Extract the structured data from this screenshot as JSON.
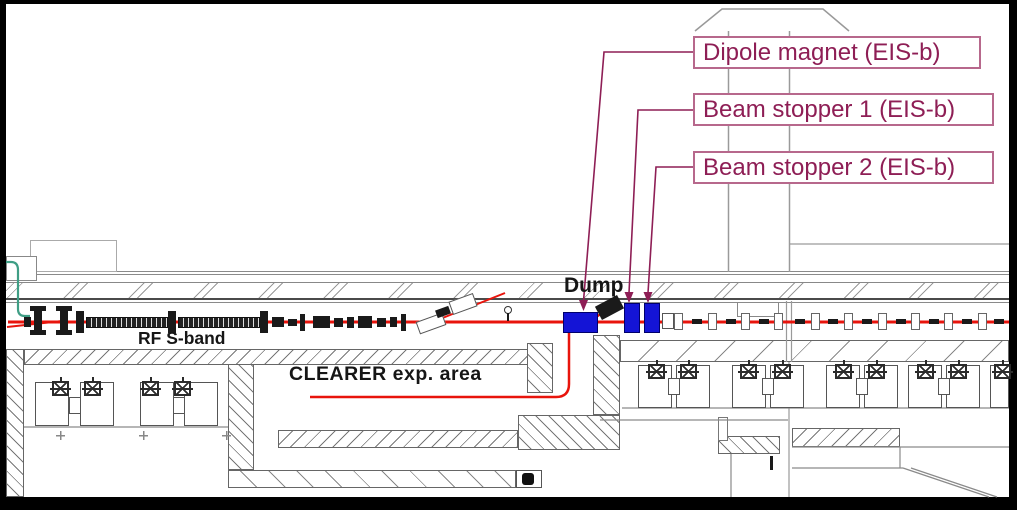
{
  "drawing": {
    "type": "accelerator-beamline-floor-plan",
    "callouts": [
      {
        "label": "Dipole magnet (EIS-b)",
        "target": "dipole-magnet"
      },
      {
        "label": "Beam stopper 1 (EIS-b)",
        "target": "beam-stopper-1"
      },
      {
        "label": "Beam stopper 2 (EIS-b)",
        "target": "beam-stopper-2"
      }
    ],
    "inline_labels": {
      "dump": "Dump",
      "rf_band": "RF S-band",
      "experimental_area": "CLEARER exp. area"
    },
    "components": [
      "electron-gun",
      "rf-s-band-structures",
      "dipole-magnet",
      "dump-block",
      "beam-stopper-1",
      "beam-stopper-2",
      "quadrupole-magnets",
      "klystron-cabinets"
    ],
    "colors": {
      "beam_red": "#e8140c",
      "component_blue": "#1414d6",
      "callout_text": "#8e1e55",
      "callout_border": "#b7688c",
      "line_gray": "#8a8a8a",
      "cable_green": "#3f9e85",
      "frame_black": "#000000"
    }
  }
}
